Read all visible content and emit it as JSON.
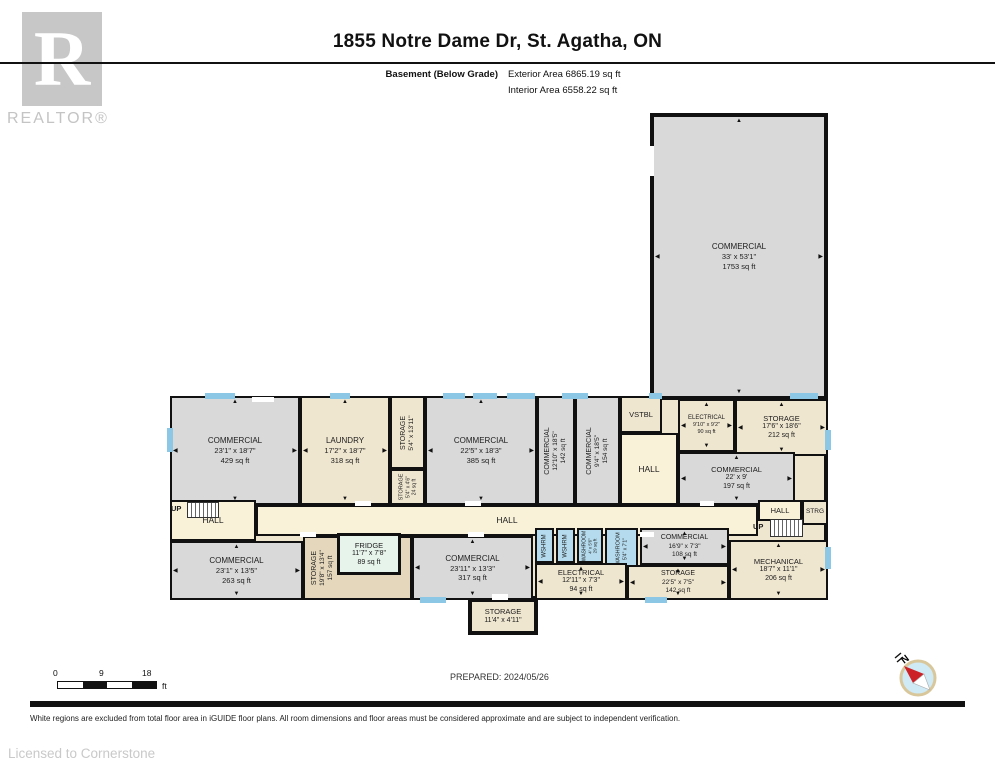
{
  "header": {
    "title": "1855 Notre Dame Dr, St. Agatha, ON",
    "floor_label": "Basement (Below Grade)",
    "exterior_area": "Exterior Area 6865.19 sq ft",
    "interior_area": "Interior Area 6558.22 sq ft"
  },
  "branding": {
    "logo_letter": "R",
    "logo_word": "REALTOR®",
    "licensed_to": "Licensed to Cornerstone"
  },
  "footer": {
    "prepared": "PREPARED: 2024/05/26",
    "disclaimer": "White regions are excluded from total floor area in iGUIDE floor plans. All room dimensions and floor areas must be considered approximate and are subject to independent verification.",
    "scale": {
      "labels": [
        "0",
        "9",
        "18"
      ],
      "unit": "ft"
    },
    "compass_label": "N"
  },
  "plan": {
    "colors": {
      "wall": "#111111",
      "gray": "#d9d9d9",
      "cream": "#efe6d0",
      "corridor": "#f9f2d9",
      "tan": "#e4d7bc",
      "blue": "#b5dcee",
      "mint": "#e7f4ec",
      "window": "#8cc8e6"
    },
    "base": {
      "x": 170,
      "y": 396,
      "w": 658,
      "h": 204,
      "fill": "cream",
      "bw": 4
    },
    "rooms": [
      {
        "id": "commercial-1753",
        "lines": [
          "COMMERCIAL",
          "33' x 53'1\"",
          "1753 sq ft"
        ],
        "x": 650,
        "y": 113,
        "w": 178,
        "h": 287,
        "fill": "gray",
        "bw": 4,
        "ar": true
      },
      {
        "id": "commercial-429",
        "lines": [
          "COMMERCIAL",
          "23'1\" x 18'7\"",
          "429 sq ft"
        ],
        "x": 170,
        "y": 396,
        "w": 130,
        "h": 109,
        "fill": "gray",
        "ar": true
      },
      {
        "id": "laundry",
        "lines": [
          "LAUNDRY",
          "17'2\" x 18'7\"",
          "318 sq ft"
        ],
        "x": 300,
        "y": 396,
        "w": 90,
        "h": 109,
        "fill": "cream",
        "ar": true
      },
      {
        "id": "storage-5-4",
        "lines": [
          "STORAGE",
          "5'4\" x 13'11\""
        ],
        "x": 390,
        "y": 396,
        "w": 35,
        "h": 73,
        "fill": "cream",
        "vertical": true,
        "fs": 7
      },
      {
        "id": "storage-24",
        "lines": [
          "STORAGE",
          "5'4\" x 4'6\"",
          "24 sq ft"
        ],
        "x": 390,
        "y": 469,
        "w": 35,
        "h": 36,
        "fill": "cream",
        "vertical": true,
        "fs": 5.5
      },
      {
        "id": "commercial-385",
        "lines": [
          "COMMERCIAL",
          "22'5\" x 18'3\"",
          "385 sq ft"
        ],
        "x": 425,
        "y": 396,
        "w": 112,
        "h": 109,
        "fill": "gray",
        "ar": true
      },
      {
        "id": "commercial-142",
        "lines": [
          "COMMERCIAL",
          "12'10\" x 18'5\"",
          "142 sq ft"
        ],
        "x": 537,
        "y": 396,
        "w": 38,
        "h": 109,
        "fill": "gray",
        "vertical": true,
        "fs": 7
      },
      {
        "id": "commercial-154",
        "lines": [
          "COMMERCIAL",
          "9'4\" x 18'5\"",
          "154 sq ft"
        ],
        "x": 575,
        "y": 396,
        "w": 45,
        "h": 109,
        "fill": "gray",
        "vertical": true,
        "fs": 7
      },
      {
        "id": "vstbl",
        "lines": [
          "VSTBL"
        ],
        "x": 620,
        "y": 396,
        "w": 42,
        "h": 37,
        "fill": "cream",
        "fs": 7.5
      },
      {
        "id": "hall-upper-right",
        "lines": [
          "HALL"
        ],
        "x": 620,
        "y": 433,
        "w": 58,
        "h": 72,
        "fill": "corridor",
        "fs": 8.5
      },
      {
        "id": "electrical-90",
        "lines": [
          "ELECTRICAL",
          "9'10\" x 9'2\"",
          "90 sq ft"
        ],
        "x": 678,
        "y": 399,
        "w": 57,
        "h": 53,
        "fill": "cream",
        "fs": 6,
        "ar": true
      },
      {
        "id": "storage-212",
        "lines": [
          "STORAGE",
          "17'6\" x 18'6\"",
          "212 sq ft"
        ],
        "x": 735,
        "y": 399,
        "w": 93,
        "h": 57,
        "fill": "cream",
        "fs": 7.5,
        "ar": true
      },
      {
        "id": "commercial-197",
        "lines": [
          "COMMERCIAL",
          "22' x 9'",
          "197 sq ft"
        ],
        "x": 678,
        "y": 452,
        "w": 117,
        "h": 53,
        "fill": "gray",
        "fs": 7.5,
        "ar": true
      },
      {
        "id": "hall-left",
        "lines": [
          "HALL"
        ],
        "x": 170,
        "y": 500,
        "w": 86,
        "h": 41,
        "fill": "corridor",
        "fs": 8.5
      },
      {
        "id": "hall-corridor",
        "lines": [
          "HALL"
        ],
        "x": 256,
        "y": 505,
        "w": 502,
        "h": 31,
        "fill": "corridor",
        "fs": 8.5
      },
      {
        "id": "hall-right",
        "lines": [
          "HALL"
        ],
        "x": 758,
        "y": 500,
        "w": 44,
        "h": 21,
        "fill": "corridor",
        "fs": 7.5
      },
      {
        "id": "strg",
        "lines": [
          "STRG"
        ],
        "x": 802,
        "y": 500,
        "w": 26,
        "h": 25,
        "fill": "cream",
        "fs": 6.5
      },
      {
        "id": "commercial-263",
        "lines": [
          "COMMERCIAL",
          "23'1\" x 13'5\"",
          "263 sq ft"
        ],
        "x": 170,
        "y": 541,
        "w": 133,
        "h": 59,
        "fill": "gray",
        "ar": true
      },
      {
        "id": "storage-157",
        "lines": [
          "STORAGE",
          "19'8\" x 13'4\"",
          "157 sq ft"
        ],
        "x": 303,
        "y": 536,
        "w": 109,
        "h": 64,
        "fill": "tan",
        "vertical": true,
        "fs": 7,
        "lxf": 0.17
      },
      {
        "id": "fridge",
        "lines": [
          "FRIDGE",
          "11'7\" x 7'8\"",
          "89 sq ft"
        ],
        "x": 337,
        "y": 533,
        "w": 64,
        "h": 42,
        "fill": "mint",
        "bw": 3,
        "fs": 7.5
      },
      {
        "id": "commercial-317",
        "lines": [
          "COMMERCIAL",
          "23'11\" x 13'3\"",
          "317 sq ft"
        ],
        "x": 412,
        "y": 536,
        "w": 121,
        "h": 64,
        "fill": "gray",
        "ar": true
      },
      {
        "id": "wshrm-1",
        "lines": [
          "WSHRM"
        ],
        "x": 535,
        "y": 528,
        "w": 19,
        "h": 35,
        "fill": "blue",
        "vertical": true,
        "fs": 6
      },
      {
        "id": "wshrm-2",
        "lines": [
          "WSHRM"
        ],
        "x": 556,
        "y": 528,
        "w": 19,
        "h": 35,
        "fill": "blue",
        "vertical": true,
        "fs": 6
      },
      {
        "id": "washroom-29",
        "lines": [
          "WASHROOM",
          "4' x 5'6\"",
          "29 sq ft"
        ],
        "x": 577,
        "y": 528,
        "w": 26,
        "h": 35,
        "fill": "blue",
        "vertical": true,
        "fs": 5
      },
      {
        "id": "washroom-54",
        "lines": [
          "WASHROOM",
          "5'4\" x 7'1\""
        ],
        "x": 605,
        "y": 528,
        "w": 33,
        "h": 41,
        "fill": "blue",
        "vertical": true,
        "fs": 5.5
      },
      {
        "id": "electrical-94",
        "lines": [
          "ELECTRICAL",
          "12'11\" x 7'3\"",
          "94 sq ft"
        ],
        "x": 535,
        "y": 563,
        "w": 92,
        "h": 37,
        "fill": "cream",
        "fs": 7.5,
        "ar": true
      },
      {
        "id": "commercial-108",
        "lines": [
          "COMMERCIAL",
          "16'9\" x 7'3\"",
          "108 sq ft"
        ],
        "x": 640,
        "y": 528,
        "w": 89,
        "h": 37,
        "fill": "gray",
        "fs": 7,
        "ar": true
      },
      {
        "id": "storage-142",
        "lines": [
          "STORAGE",
          "22'5\" x 7'5\"",
          "142 sq ft"
        ],
        "x": 627,
        "y": 565,
        "w": 102,
        "h": 35,
        "fill": "cream",
        "fs": 7,
        "ar": true
      },
      {
        "id": "mechanical",
        "lines": [
          "MECHANICAL",
          "18'7\" x 11'1\"",
          "206 sq ft"
        ],
        "x": 729,
        "y": 540,
        "w": 99,
        "h": 60,
        "fill": "cream",
        "fs": 7.5,
        "ar": true
      },
      {
        "id": "storage-bump",
        "lines": [
          "STORAGE",
          "11'4\" x 4'11\""
        ],
        "x": 468,
        "y": 598,
        "w": 70,
        "h": 37,
        "fill": "cream",
        "bw": 4,
        "fs": 7.5
      }
    ],
    "stairs": [
      {
        "x": 187,
        "y": 502,
        "w": 32,
        "h": 16,
        "label": "UP",
        "lx": 171,
        "ly": 504
      },
      {
        "x": 770,
        "y": 519,
        "w": 33,
        "h": 18,
        "label": "UP",
        "lx": 753,
        "ly": 522
      }
    ],
    "windows": [
      {
        "x": 205,
        "y": 393,
        "w": 30,
        "h": 6
      },
      {
        "x": 330,
        "y": 393,
        "w": 20,
        "h": 6
      },
      {
        "x": 443,
        "y": 393,
        "w": 22,
        "h": 6
      },
      {
        "x": 473,
        "y": 393,
        "w": 24,
        "h": 6
      },
      {
        "x": 507,
        "y": 393,
        "w": 28,
        "h": 6
      },
      {
        "x": 562,
        "y": 393,
        "w": 26,
        "h": 6
      },
      {
        "x": 649,
        "y": 393,
        "w": 13,
        "h": 6
      },
      {
        "x": 790,
        "y": 393,
        "w": 28,
        "h": 6
      },
      {
        "x": 167,
        "y": 428,
        "w": 6,
        "h": 24
      },
      {
        "x": 825,
        "y": 430,
        "w": 6,
        "h": 20
      },
      {
        "x": 825,
        "y": 547,
        "w": 6,
        "h": 22
      },
      {
        "x": 420,
        "y": 597,
        "w": 26,
        "h": 6
      },
      {
        "x": 645,
        "y": 597,
        "w": 22,
        "h": 6
      }
    ],
    "doors": [
      {
        "x": 252,
        "y": 397,
        "w": 22,
        "h": 5
      },
      {
        "x": 646,
        "y": 146,
        "w": 8,
        "h": 30
      },
      {
        "x": 355,
        "y": 501,
        "w": 16,
        "h": 5
      },
      {
        "x": 465,
        "y": 501,
        "w": 16,
        "h": 5
      },
      {
        "x": 700,
        "y": 501,
        "w": 14,
        "h": 5
      },
      {
        "x": 300,
        "y": 532,
        "w": 16,
        "h": 5
      },
      {
        "x": 468,
        "y": 532,
        "w": 16,
        "h": 5
      },
      {
        "x": 640,
        "y": 532,
        "w": 14,
        "h": 5
      },
      {
        "x": 492,
        "y": 594,
        "w": 16,
        "h": 6
      }
    ]
  }
}
